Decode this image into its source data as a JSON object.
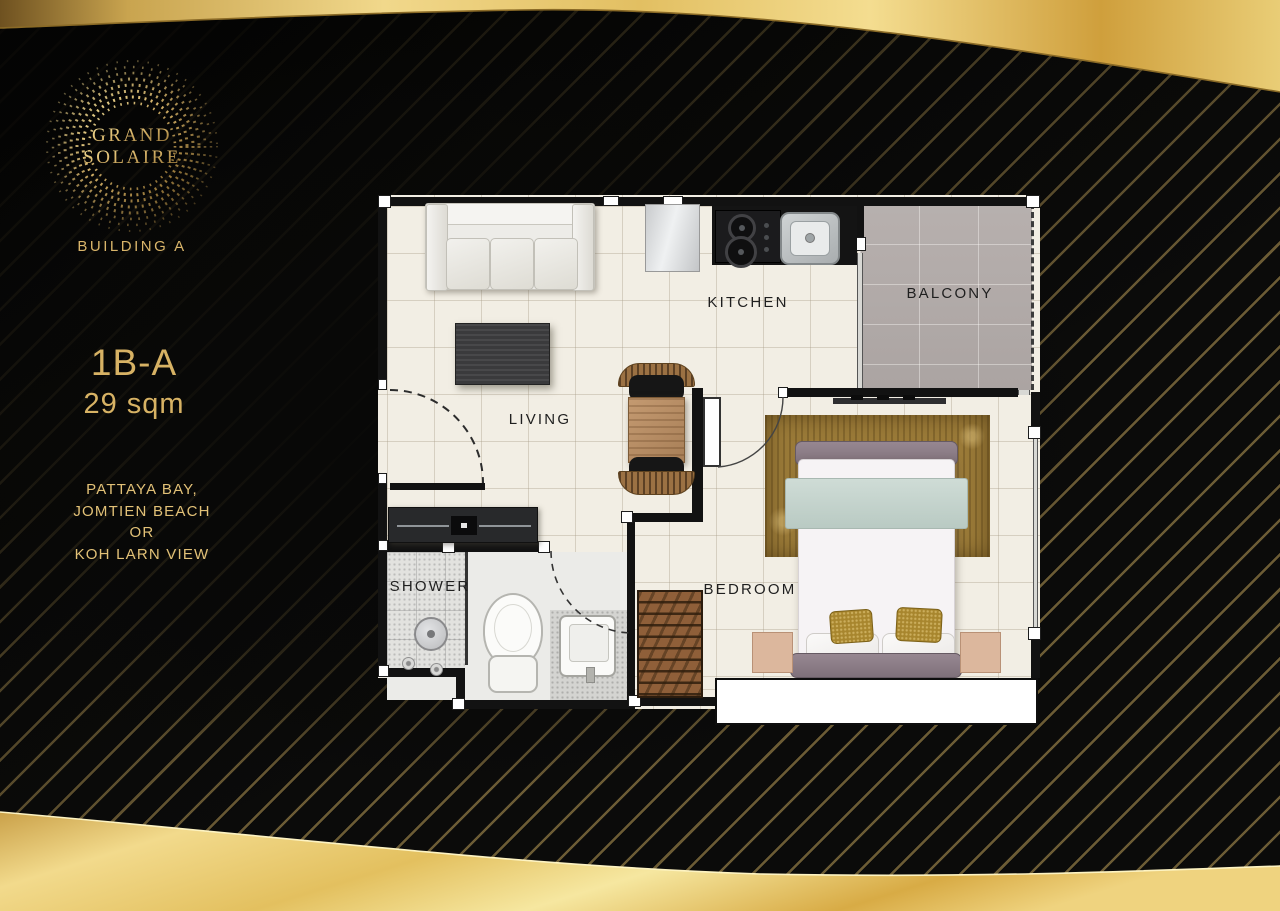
{
  "branding": {
    "logo_line1": "GRAND",
    "logo_line2": "SOLAIRE",
    "building_label": "BUILDING A"
  },
  "unit": {
    "type_name": "1B-A",
    "area": "29 sqm",
    "view_lines": [
      "PATTAYA BAY,",
      "JOMTIEN BEACH",
      "OR",
      "KOH LARN VIEW"
    ]
  },
  "floorplan": {
    "room_labels": {
      "kitchen": "KITCHEN",
      "living": "LIVING",
      "balcony": "BALCONY",
      "bedroom": "BEDROOM",
      "shower": "SHOWER"
    }
  },
  "colors": {
    "gold_text": "#D9B56A",
    "gold_band": "#EFD385",
    "background": "#0B0B0A",
    "wall": "#121212",
    "floor_cream": "#F2EEE4",
    "balcony_floor": "#B1AAA8",
    "rug_gold": "#9A7A38"
  }
}
